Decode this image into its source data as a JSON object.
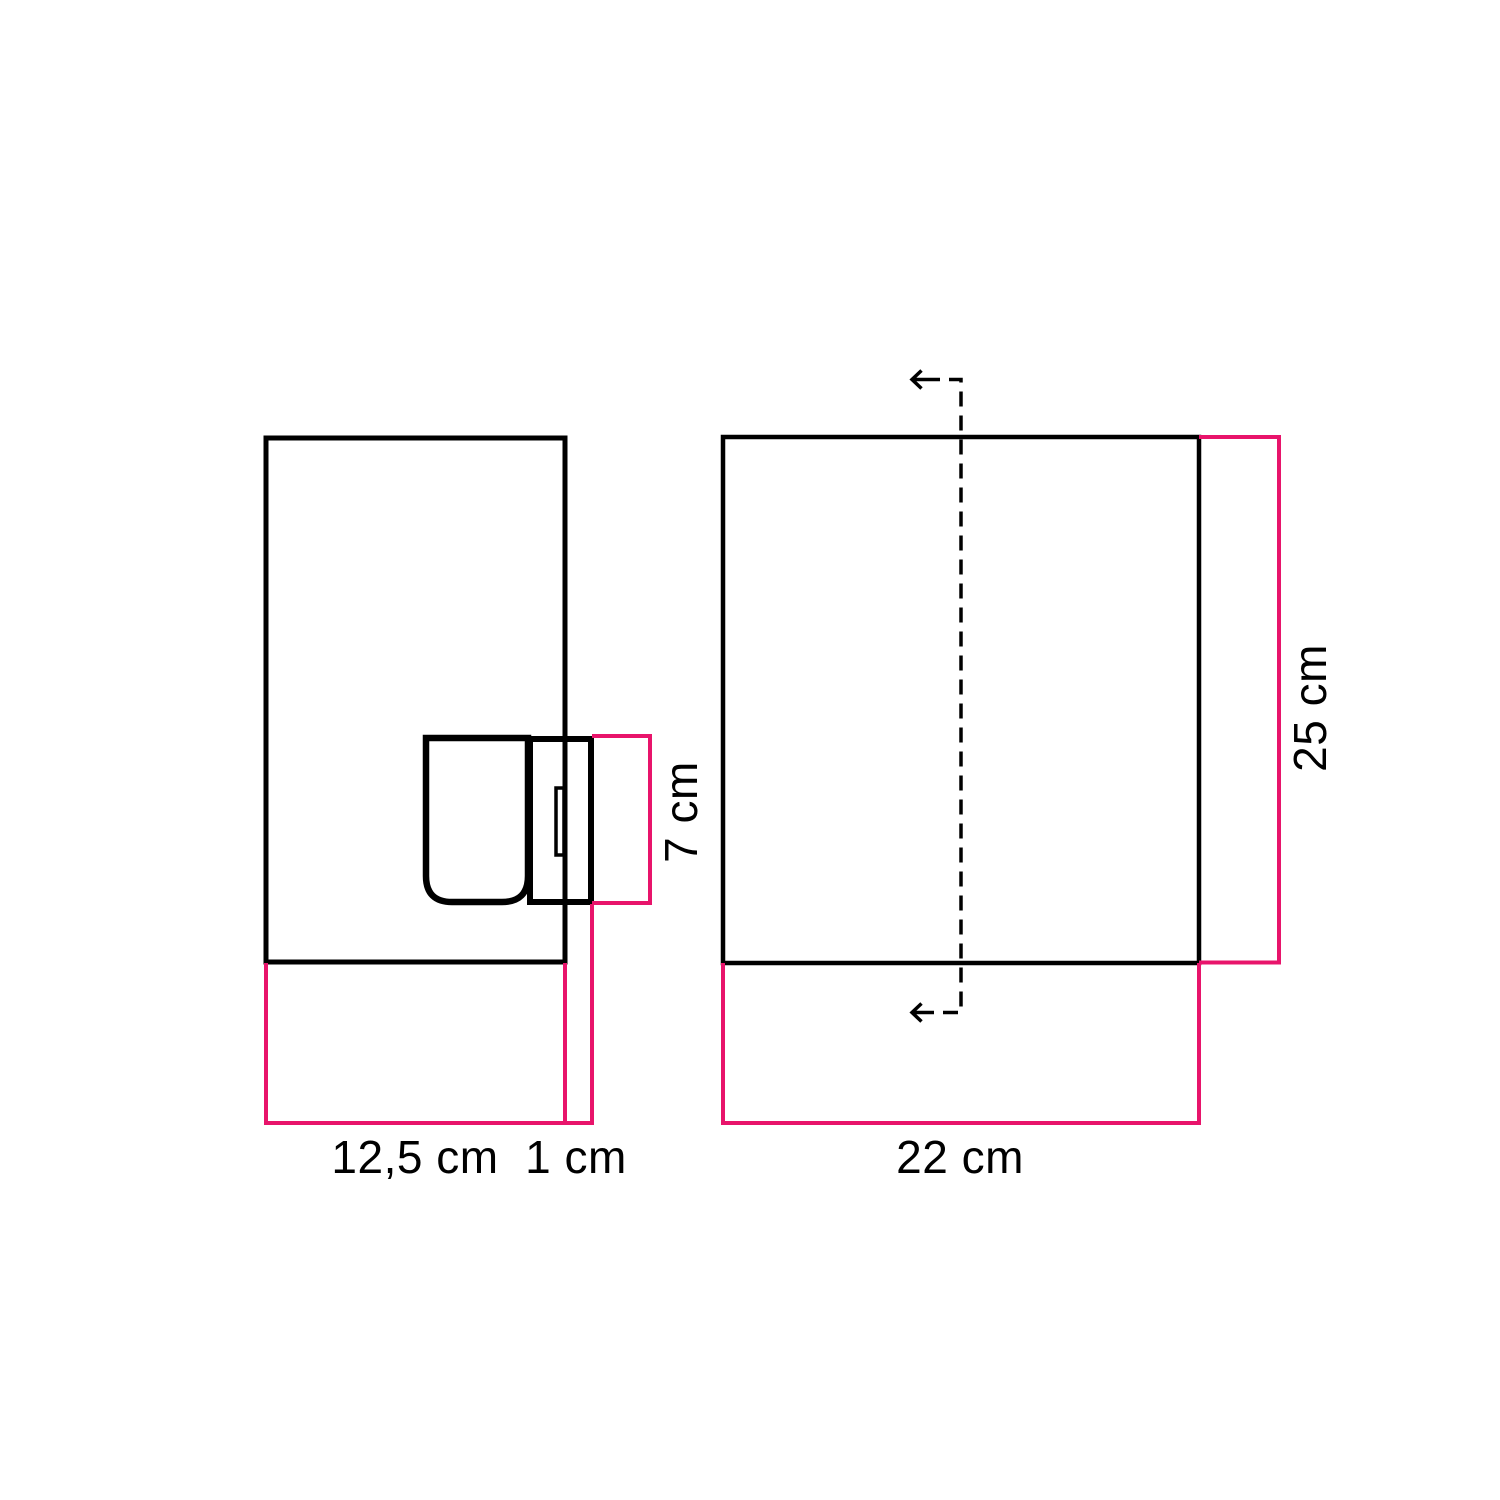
{
  "diagram": {
    "name": "wall-lamp-dimension-drawing",
    "colors": {
      "outline": "#000000",
      "dimension": "#e8146b"
    },
    "side_view": {
      "labels": {
        "depth": "12,5 cm",
        "holder_offset": "1 cm",
        "holder_height": "7 cm"
      }
    },
    "front_view": {
      "labels": {
        "width": "22 cm",
        "height": "25 cm"
      }
    }
  }
}
